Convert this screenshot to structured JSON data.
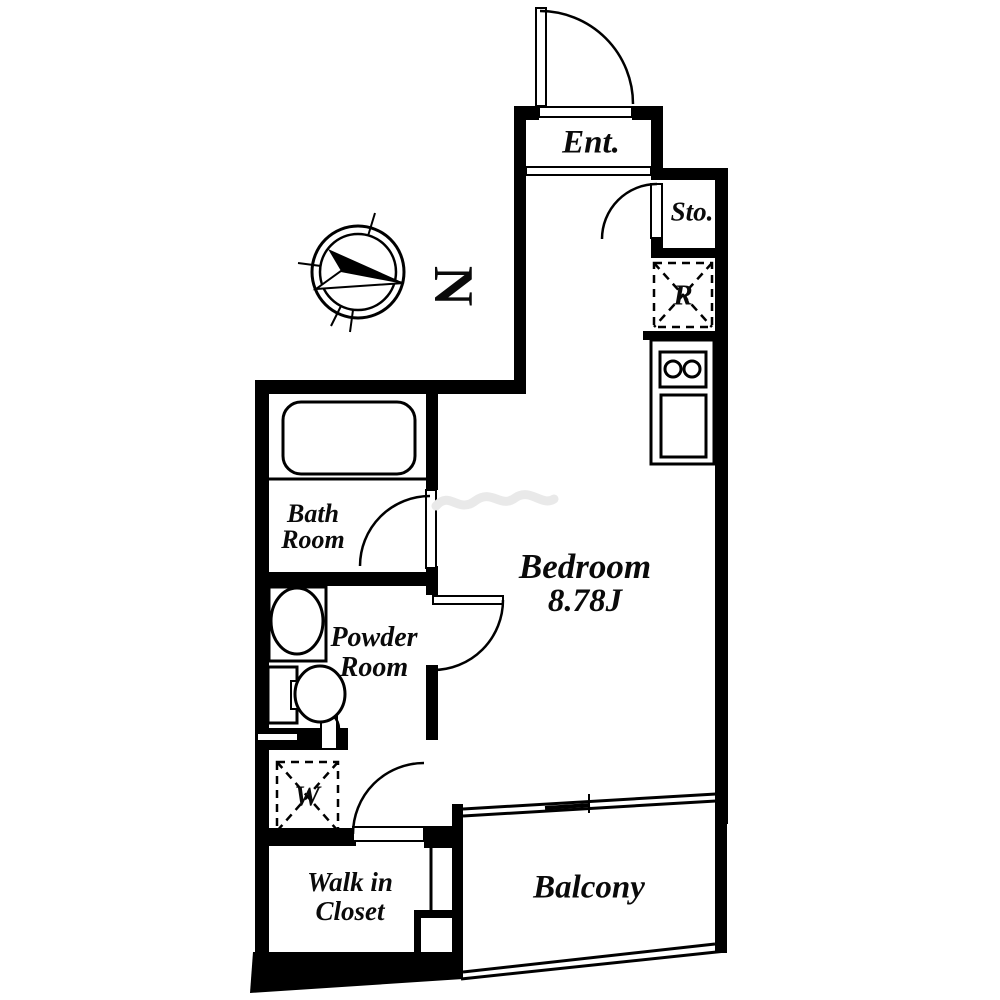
{
  "floor_plan": {
    "compass_letter": "N",
    "labels": {
      "entrance": "Ent.",
      "storage": "Sto.",
      "refrigerator_symbol": "R",
      "bedroom_name": "Bedroom",
      "bedroom_area": "8.78J",
      "bath_room_line1": "Bath",
      "bath_room_line2": "Room",
      "powder_room_line1": "Powder",
      "powder_room_line2": "Room",
      "washer_symbol": "W",
      "walk_in_closet_line1": "Walk in",
      "walk_in_closet_line2": "Closet",
      "balcony": "Balcony"
    },
    "colors": {
      "line": "#000000",
      "background": "#ffffff"
    }
  }
}
